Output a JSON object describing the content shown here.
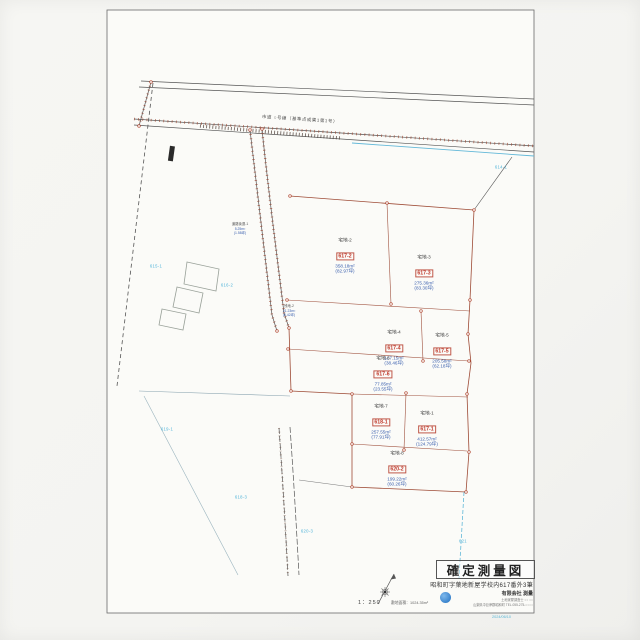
{
  "title_block": {
    "title": "確定測量図",
    "subtitle": "昭和町字葉地新屋学校内617番外3筆",
    "scale": "1：250",
    "area_note": "敷地面積：1024.35m²",
    "firm_name": "有限会社 測量",
    "firm_line1": "土地家屋調査士 ○○ ○○",
    "firm_line2": "山梨県中巨摩郡昭和町 TEL.055-275-○○○○",
    "date": "2024/06/10"
  },
  "roads": {
    "main_label": "市道 ○号線（基準点成果1第1号）"
  },
  "parcels": [
    {
      "name": "宅地-2",
      "num": "617-2",
      "area": "358.18m²",
      "tsubo": "(82.97坪)"
    },
    {
      "name": "宅地-3",
      "num": "617-3",
      "area": "275.36m²",
      "tsubo": "(83.30坪)"
    },
    {
      "name": "宅地-4",
      "num": "617-4",
      "area": "127.15m²",
      "tsubo": "(38.46坪)"
    },
    {
      "name": "宅地-5",
      "num": "617-5",
      "area": "205.58m²",
      "tsubo": "(62.18坪)"
    },
    {
      "name": "宅地-6",
      "num": "617-6",
      "area": "77.85m²",
      "tsubo": "(23.55坪)"
    },
    {
      "name": "宅地-7",
      "num": "618-1",
      "area": "257.55m²",
      "tsubo": "(77.91坪)"
    },
    {
      "name": "宅地-1",
      "num": "617-1",
      "area": "412.57m²",
      "tsubo": "(124.79坪)"
    },
    {
      "name": "宅地-8",
      "num": "620-2",
      "area": "199.22m²",
      "tsubo": "(60.26坪)"
    }
  ],
  "annotations": [
    {
      "name": "道路後退-1",
      "area": "5.25m²",
      "tsubo": "(1.58坪)"
    },
    {
      "name": "残地-2",
      "area": "21.23m²",
      "tsubo": "(6.42坪)"
    }
  ],
  "neighbors": [
    {
      "label": "615-1"
    },
    {
      "label": "616-2"
    },
    {
      "label": "614-1"
    },
    {
      "label": "619-1"
    },
    {
      "label": "618-3"
    },
    {
      "label": "620-3"
    },
    {
      "label": "621"
    }
  ],
  "colors": {
    "boundary_red": "#9e4b36",
    "lot_num_red": "#c0392b",
    "area_blue": "#3a5fae",
    "neighbor_cyan": "#4fb3d9",
    "line_black": "#4a4a4a",
    "stamp_blue": "#2a7fd4"
  }
}
